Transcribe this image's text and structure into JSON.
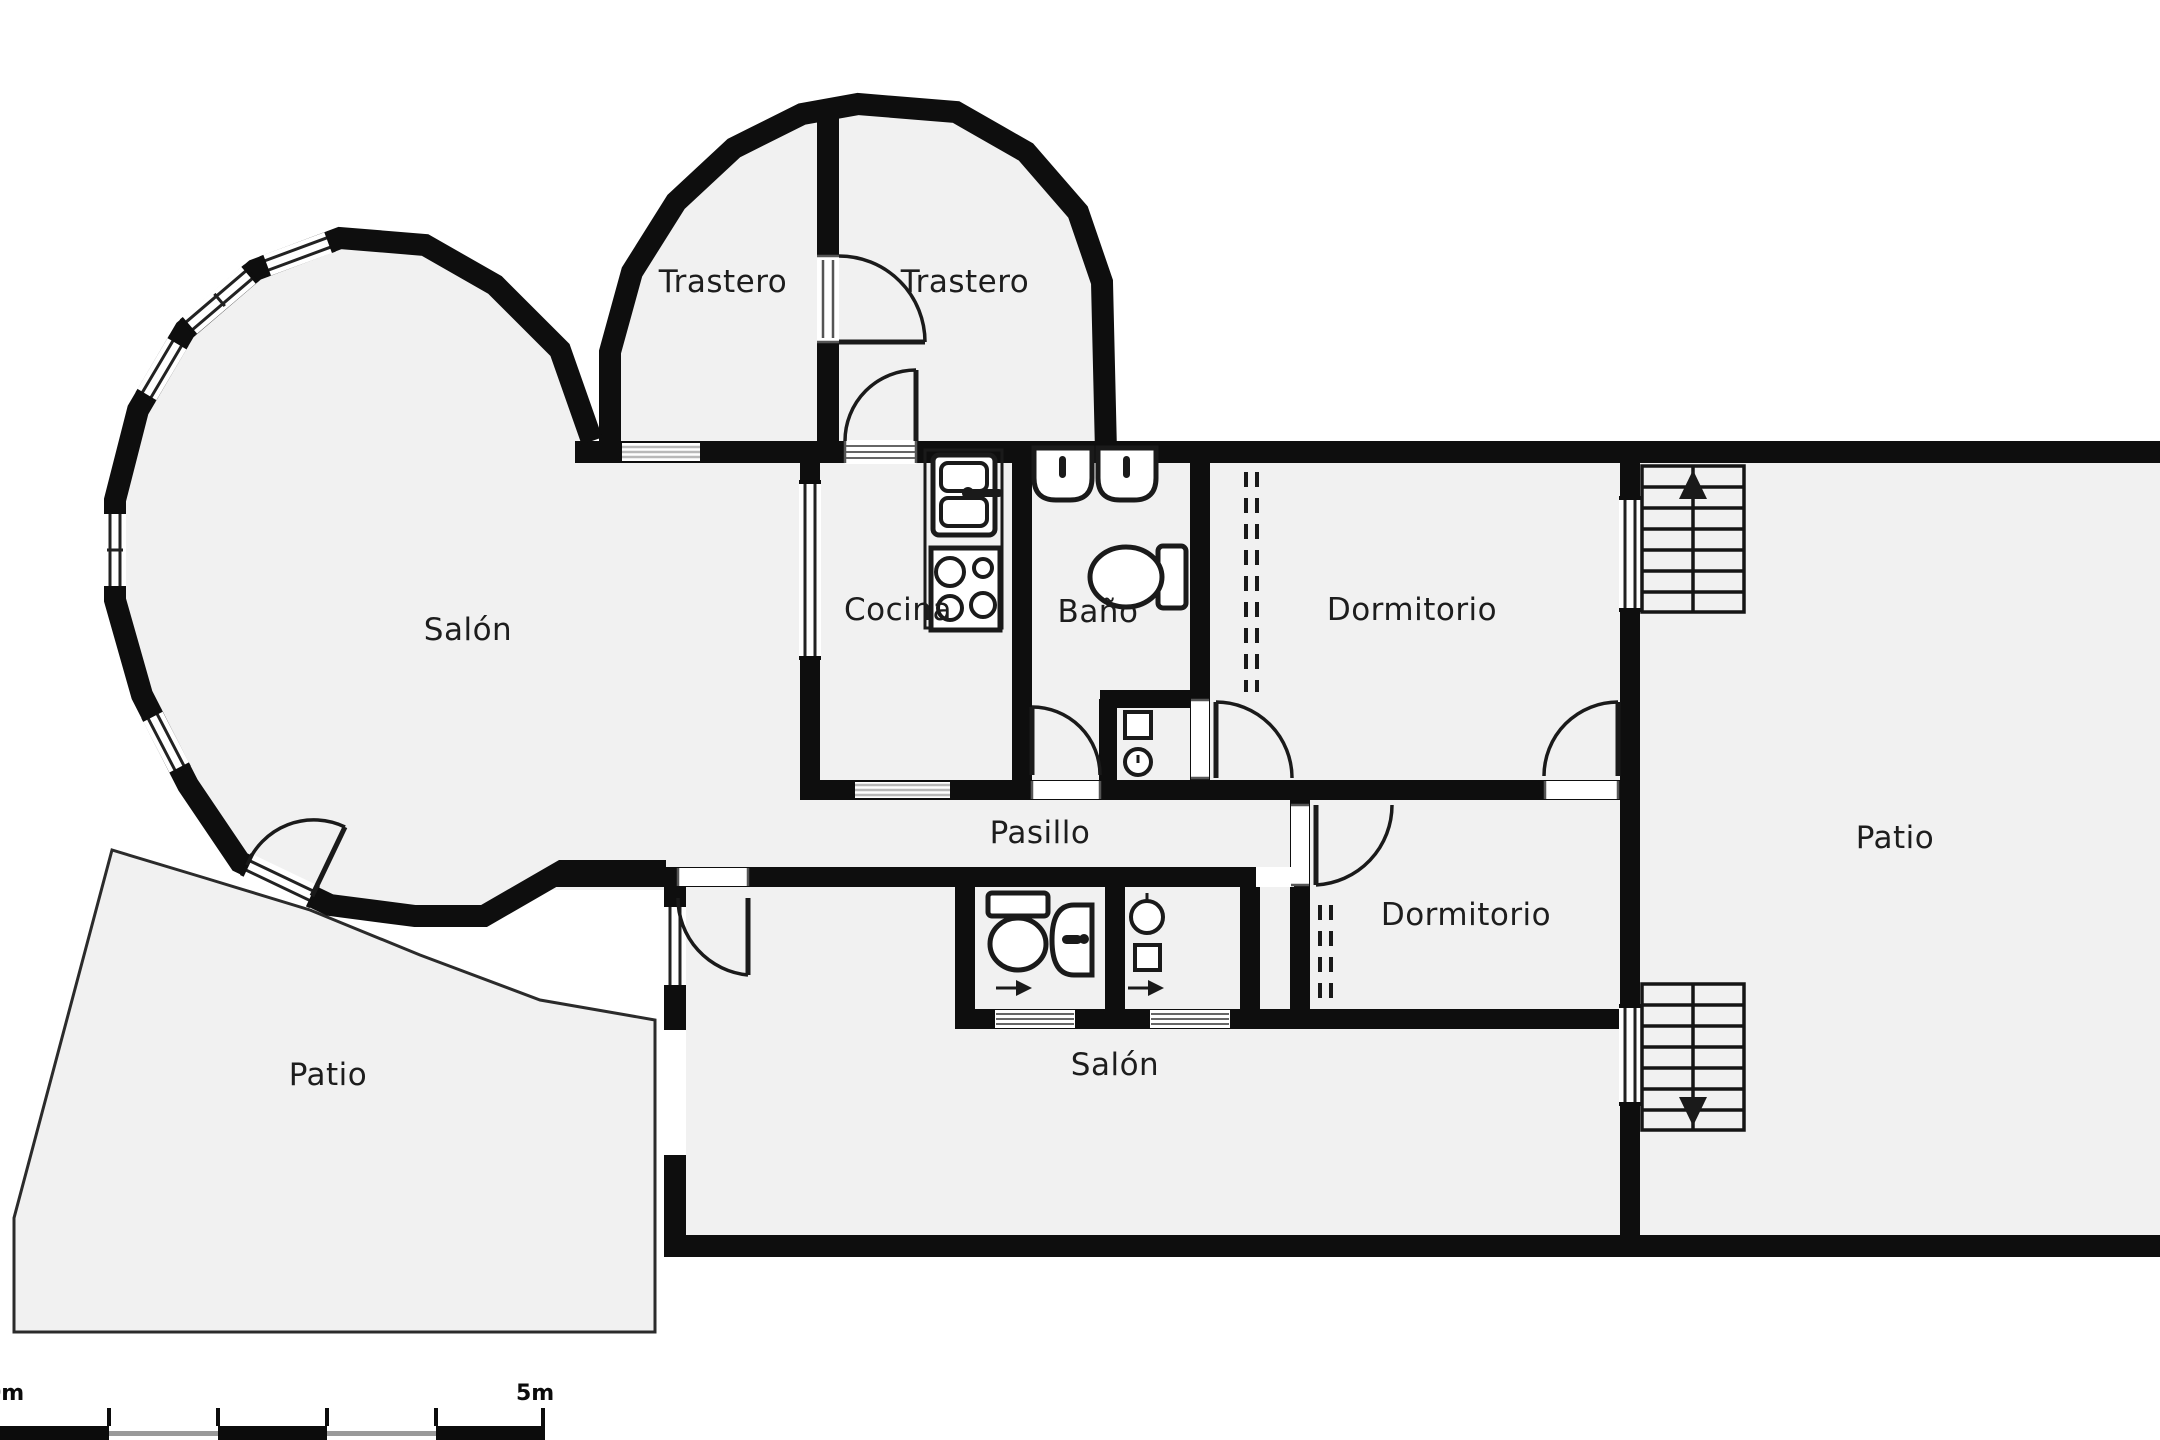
{
  "plan": {
    "type": "floorplan",
    "language": "es",
    "rooms": [
      {
        "id": "trastero-left",
        "label": "Trastero"
      },
      {
        "id": "trastero-right",
        "label": "Trastero"
      },
      {
        "id": "salon-left",
        "label": "Salón"
      },
      {
        "id": "cocina",
        "label": "Cocina"
      },
      {
        "id": "bano",
        "label": "Baño"
      },
      {
        "id": "dormitorio-top",
        "label": "Dormitorio"
      },
      {
        "id": "patio-right",
        "label": "Patio"
      },
      {
        "id": "pasillo",
        "label": "Pasillo"
      },
      {
        "id": "dormitorio-mid",
        "label": "Dormitorio"
      },
      {
        "id": "salon-bottom",
        "label": "Salón"
      },
      {
        "id": "patio-left",
        "label": "Patio"
      }
    ],
    "scale_bar": {
      "start_label": "0m",
      "end_label": "5m",
      "segments": 5,
      "meters_total": 5
    },
    "stairs": {
      "flights": 2,
      "steps_per_flight": 7,
      "top_flight_direction": "up",
      "bottom_flight_direction": "down"
    },
    "fixtures": [
      "kitchen-sink",
      "stove-4-burners",
      "washbasin",
      "washbasin",
      "toilet",
      "toilet",
      "small-washbasin",
      "laundry-sink",
      "washer",
      "shower-basin"
    ],
    "colors": {
      "wall": "#0e0e0e",
      "room_fill": "#f1f1f1",
      "outside": "#ffffff",
      "label": "#1d1d1d",
      "threshold": "#b9b9b9"
    }
  }
}
